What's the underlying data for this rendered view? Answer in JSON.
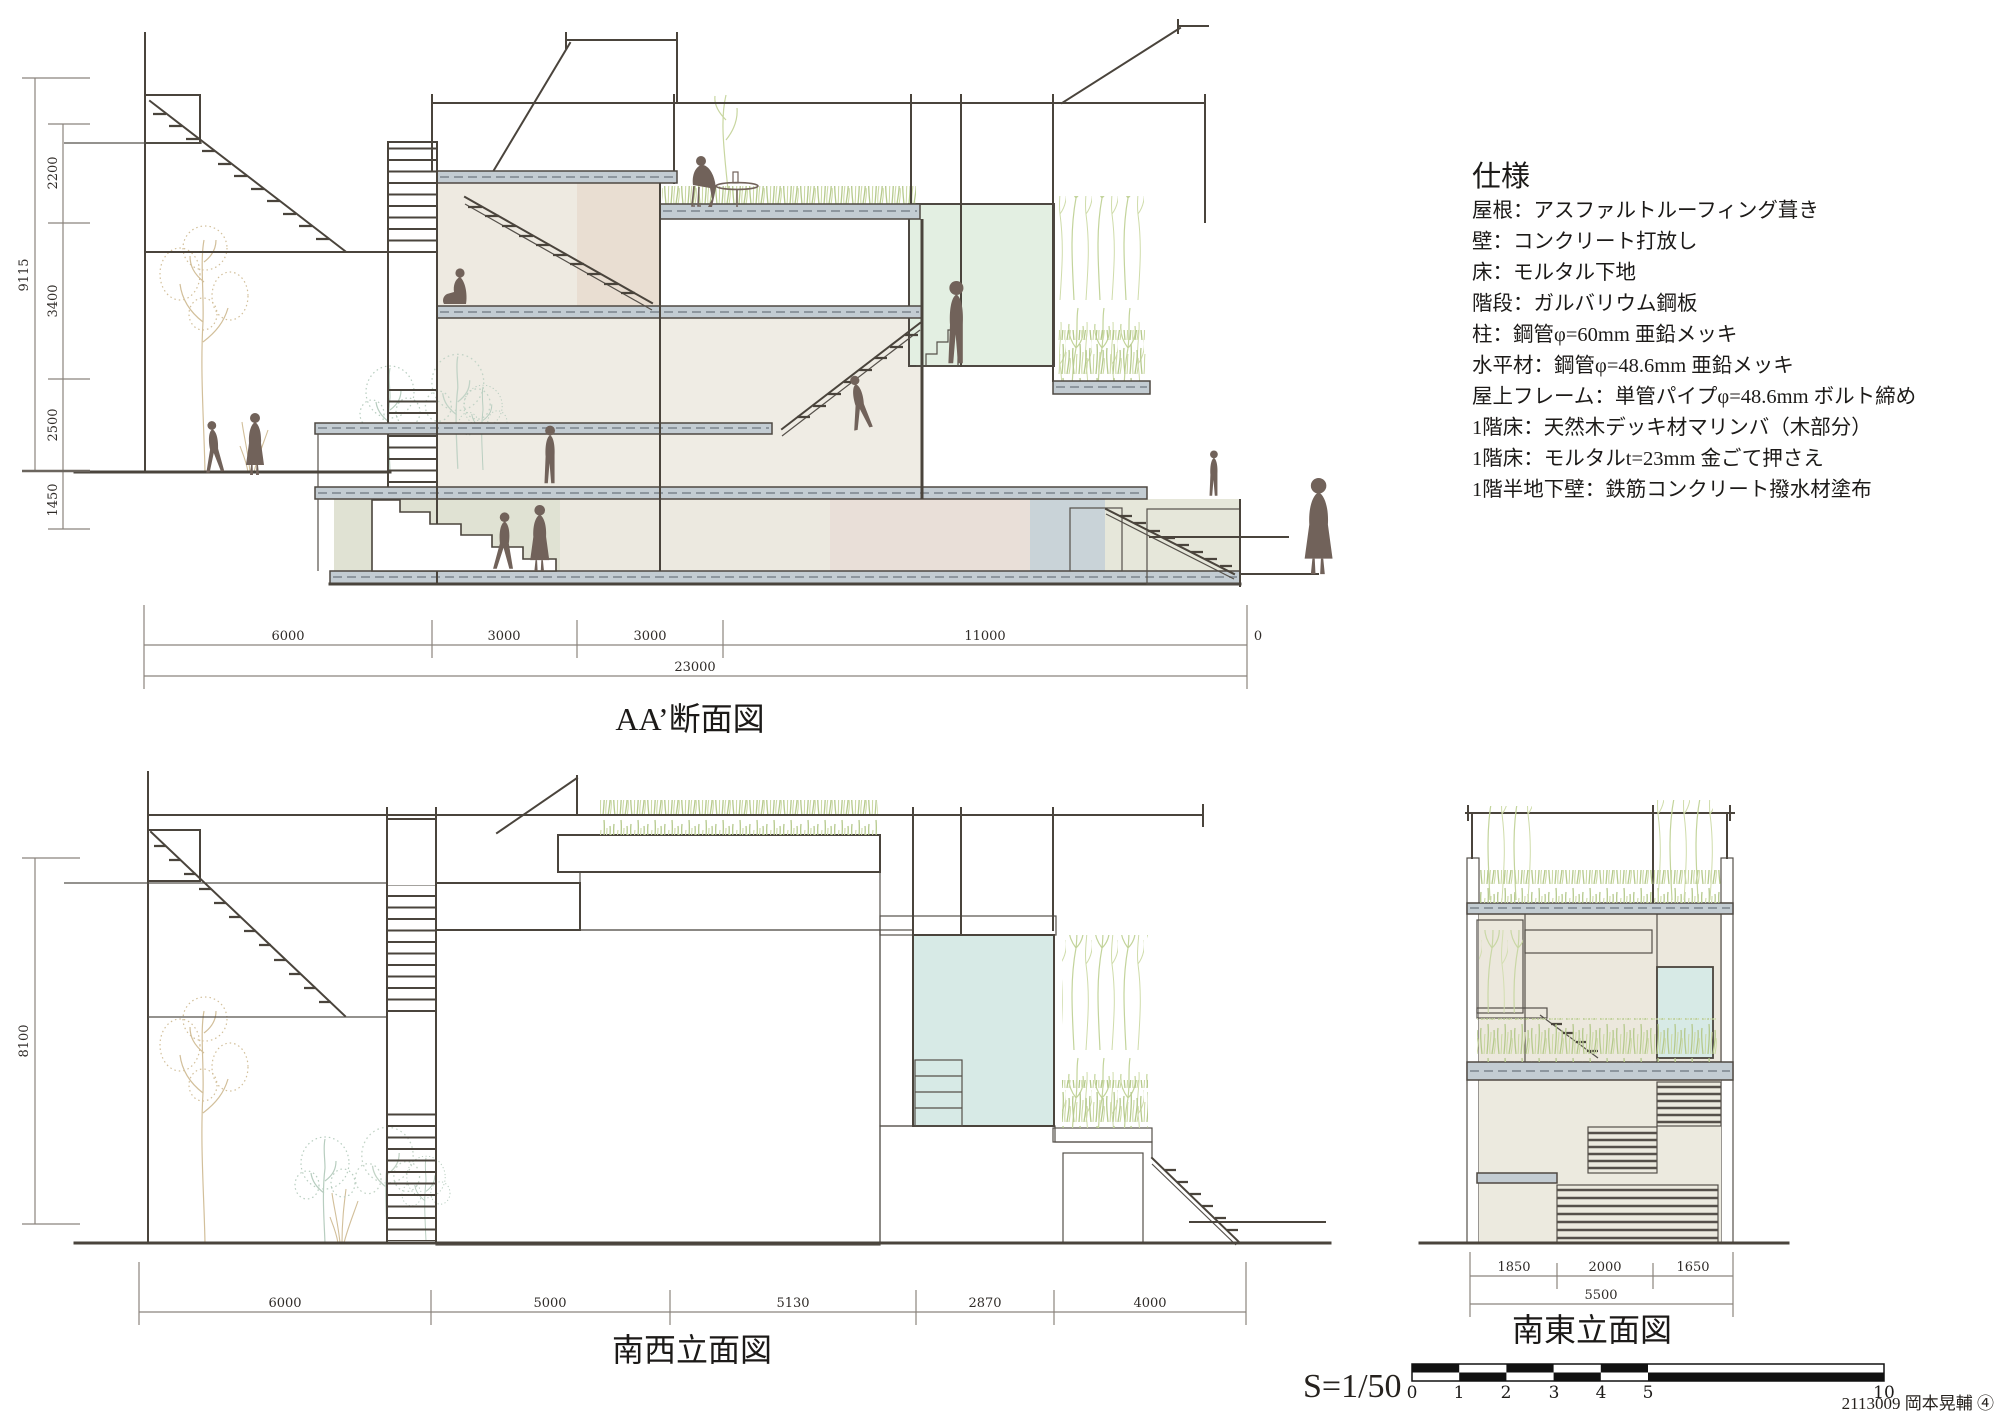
{
  "specifications": {
    "title": "仕様",
    "items": [
      "屋根：アスファルトルーフィング葺き",
      "壁：コンクリート打放し",
      "床：モルタル下地",
      "階段：ガルバリウム鋼板",
      "柱：鋼管φ=60mm 亜鉛メッキ",
      "水平材：鋼管φ=48.6mm 亜鉛メッキ",
      "屋上フレーム：単管パイプφ=48.6mm ボルト締め",
      "1階床：天然木デッキ材マリンバ（木部分）",
      "1階床：モルタルt=23mm 金ごて押さえ",
      "1階半地下壁：鉄筋コンクリート撥水材塗布"
    ]
  },
  "section_aa": {
    "title": "AA’断面図",
    "dim_bottom": {
      "segs": [
        "6000",
        "3000",
        "3000",
        "11000"
      ],
      "zero": "0",
      "total": "23000"
    },
    "dim_left": {
      "total": "9115",
      "segs": [
        "2200",
        "3400",
        "2500",
        "1450"
      ]
    }
  },
  "elev_sw": {
    "title": "南西立面図",
    "height": "8100",
    "dims": [
      "6000",
      "5000",
      "5130",
      "2870",
      "4000"
    ]
  },
  "elev_se": {
    "title": "南東立面図",
    "dims": [
      "1850",
      "2000",
      "1650"
    ],
    "total": "5500"
  },
  "scalebar": {
    "label": "S=1/50",
    "ticks": [
      "0",
      "1",
      "2",
      "3",
      "4",
      "5"
    ],
    "end": "10"
  },
  "credit": "2113009 岡本晃輔 ④",
  "colors": {
    "line": "#4a443c",
    "slab": "#c3ccd2",
    "tile_wall": "#cdd4d9",
    "glass_green": "#e3efe2",
    "glass_blue": "#d7eae6",
    "wall_cream": "#eeeae1",
    "wall_pink": "#e9ded2",
    "wall_green": "#e0e2d3",
    "grass": "#b9cc92",
    "tree_beige": "#d2bf9a",
    "tree_green": "#b7cdbf",
    "people": "#71625a"
  }
}
